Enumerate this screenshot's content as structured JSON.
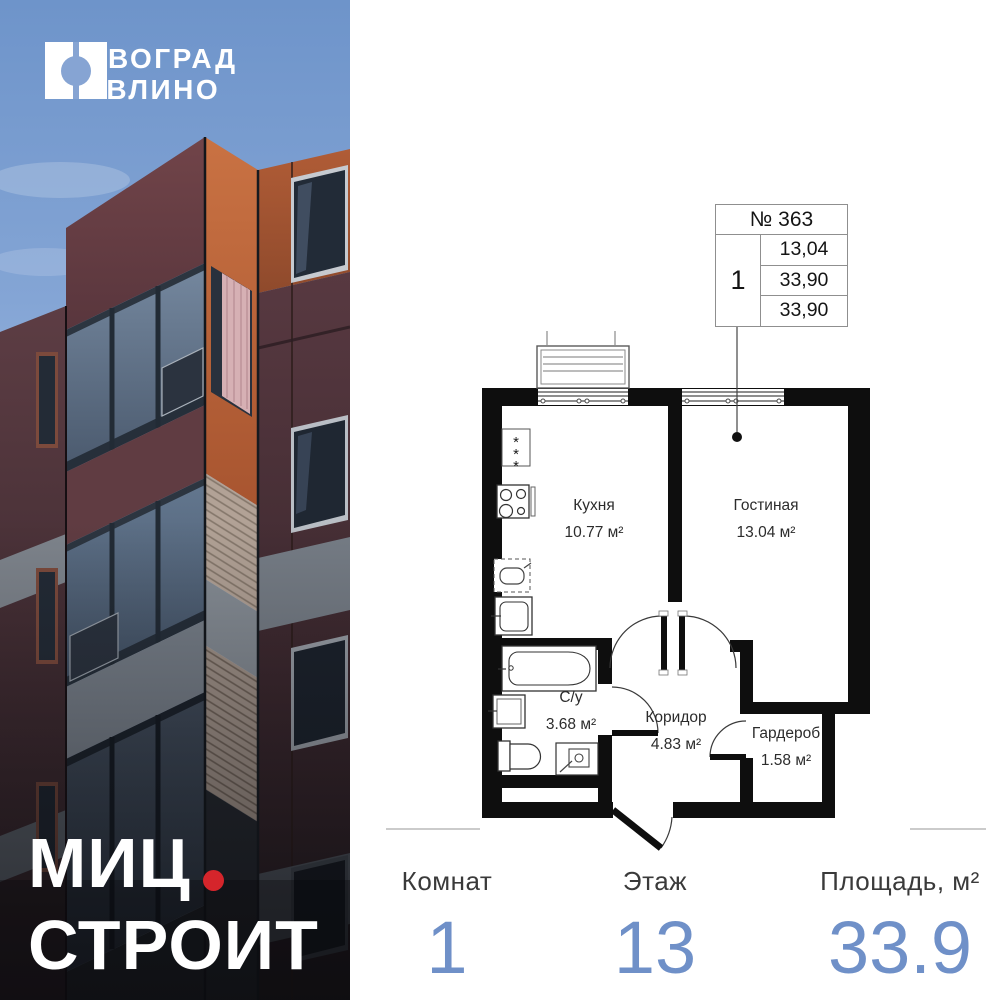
{
  "brand": {
    "complex_name_line1": "НОВОГРАД",
    "complex_name_line2": "ПАВЛИНО",
    "developer_name_line1": "МИЦ",
    "developer_name_line2": "СТРОИТ"
  },
  "unit_table": {
    "number": "№ 363",
    "rooms_count": "1",
    "values": [
      "13,04",
      "33,90",
      "33,90"
    ]
  },
  "floor_plan": {
    "rooms": [
      {
        "name": "Кухня",
        "area": "10.77 м²"
      },
      {
        "name": "Гостиная",
        "area": "13.04 м²"
      },
      {
        "name": "С/у",
        "area": "3.68 м²"
      },
      {
        "name": "Коридор",
        "area": "4.83 м²"
      },
      {
        "name": "Гардероб",
        "area": "1.58 м²"
      }
    ],
    "fixtures": [
      "ventilation-shaft",
      "stove",
      "kitchen-sink",
      "fridge",
      "bathtub",
      "bathroom-sink",
      "toilet",
      "washing-machine"
    ]
  },
  "summary": {
    "columns": [
      {
        "label": "Комнат",
        "value": "1"
      },
      {
        "label": "Этаж",
        "value": "13"
      },
      {
        "label": "Площадь, м²",
        "value": "33.9"
      }
    ]
  },
  "colors": {
    "accent_blue": "#6F90C8",
    "brand_red": "#D5252B",
    "sky_blue": "#86A4D3",
    "terracotta": "#B85F38",
    "plan_wall": "#0E0E0E"
  }
}
